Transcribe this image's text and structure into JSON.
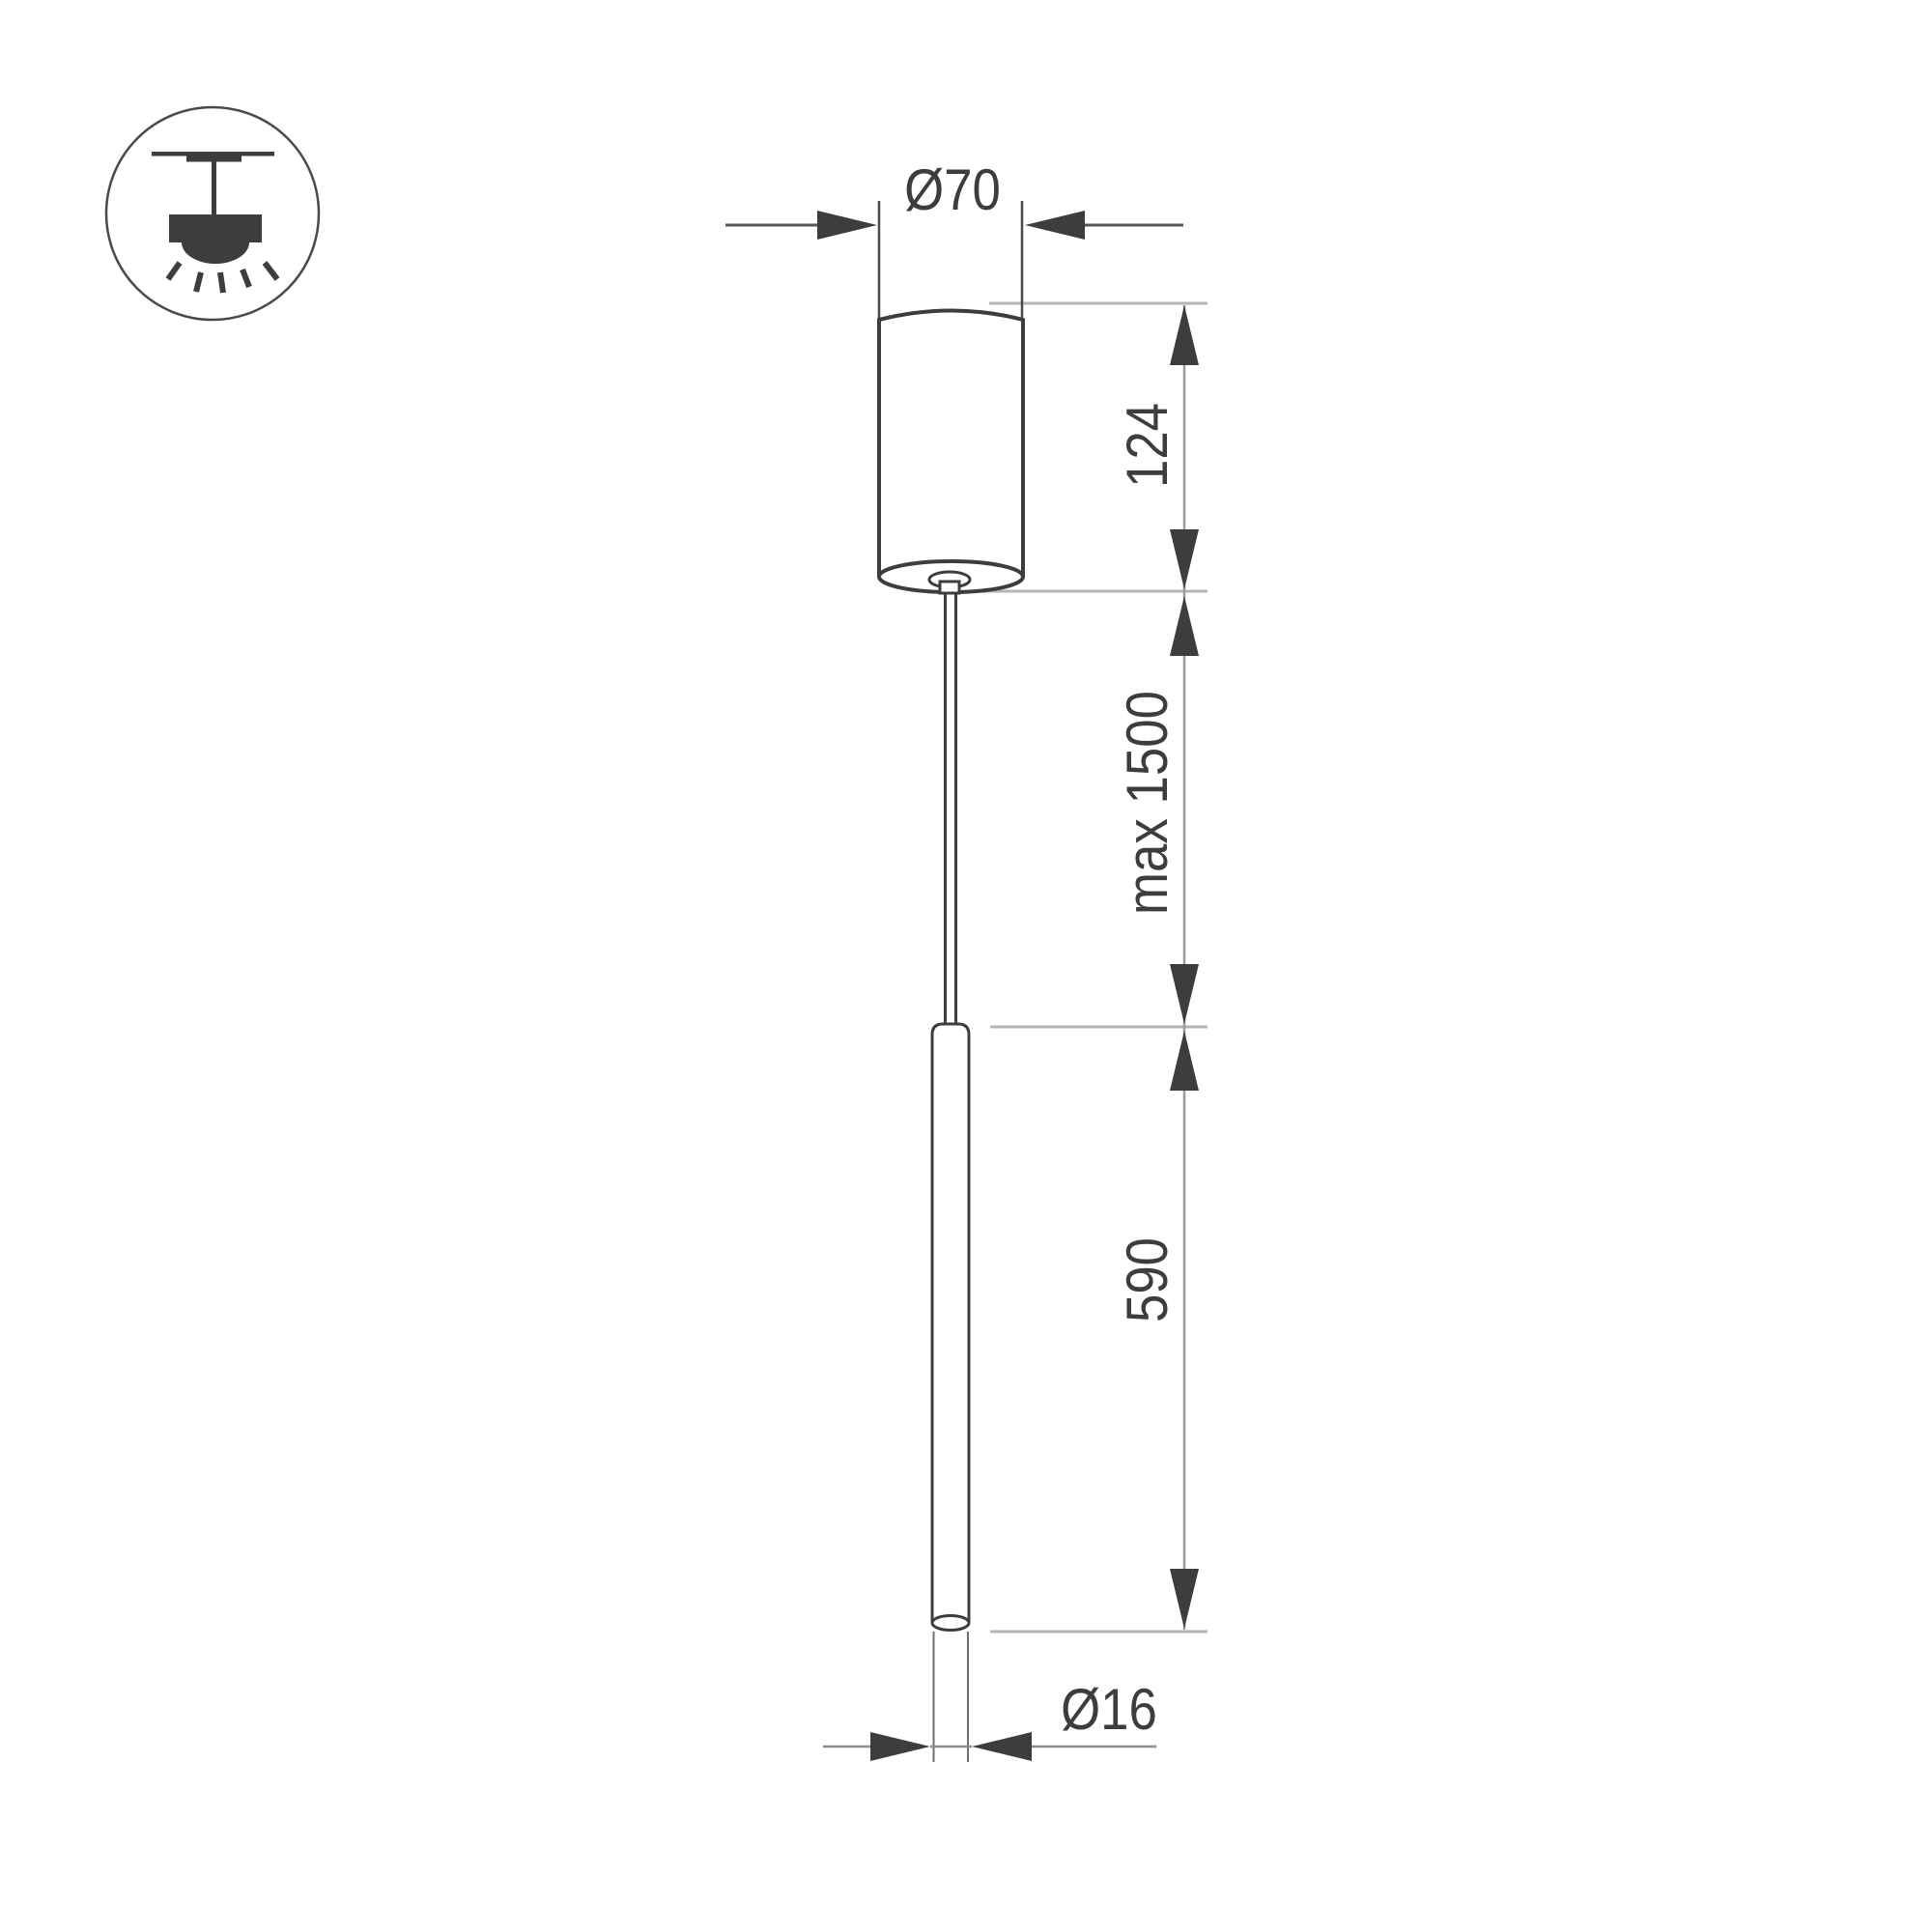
{
  "page": {
    "background": "#ffffff",
    "kind": "pendant luminaire dimension drawing"
  },
  "legend_icon": {
    "name": "ceiling-pendant-mount-icon"
  },
  "dimensions": {
    "canopy_diameter": "Ø70",
    "canopy_height": "124",
    "suspension_length": "max 1500",
    "lamp_length": "590",
    "lamp_diameter": "Ø16"
  },
  "colors": {
    "line_dark": "#3d3d3d",
    "line_mid": "#9c9c9c",
    "line_light": "#b4b4b4",
    "background": "#ffffff"
  }
}
